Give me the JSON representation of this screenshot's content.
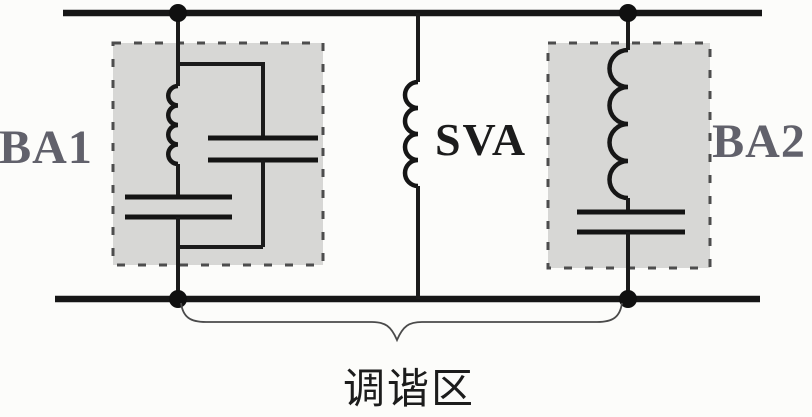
{
  "labels": {
    "left_block": "BA1",
    "center_inductor": "SVA",
    "right_block": "BA2",
    "brace_caption": "调谐区"
  },
  "colors": {
    "wire": "#1b1b1b",
    "block_fill": "#d7d7d5",
    "block_border": "#4d4d4d",
    "block_label_gray": "#61616b",
    "text_black": "#1c1c1c",
    "brace": "#4a4a4a",
    "background": "#fcfcfa"
  }
}
